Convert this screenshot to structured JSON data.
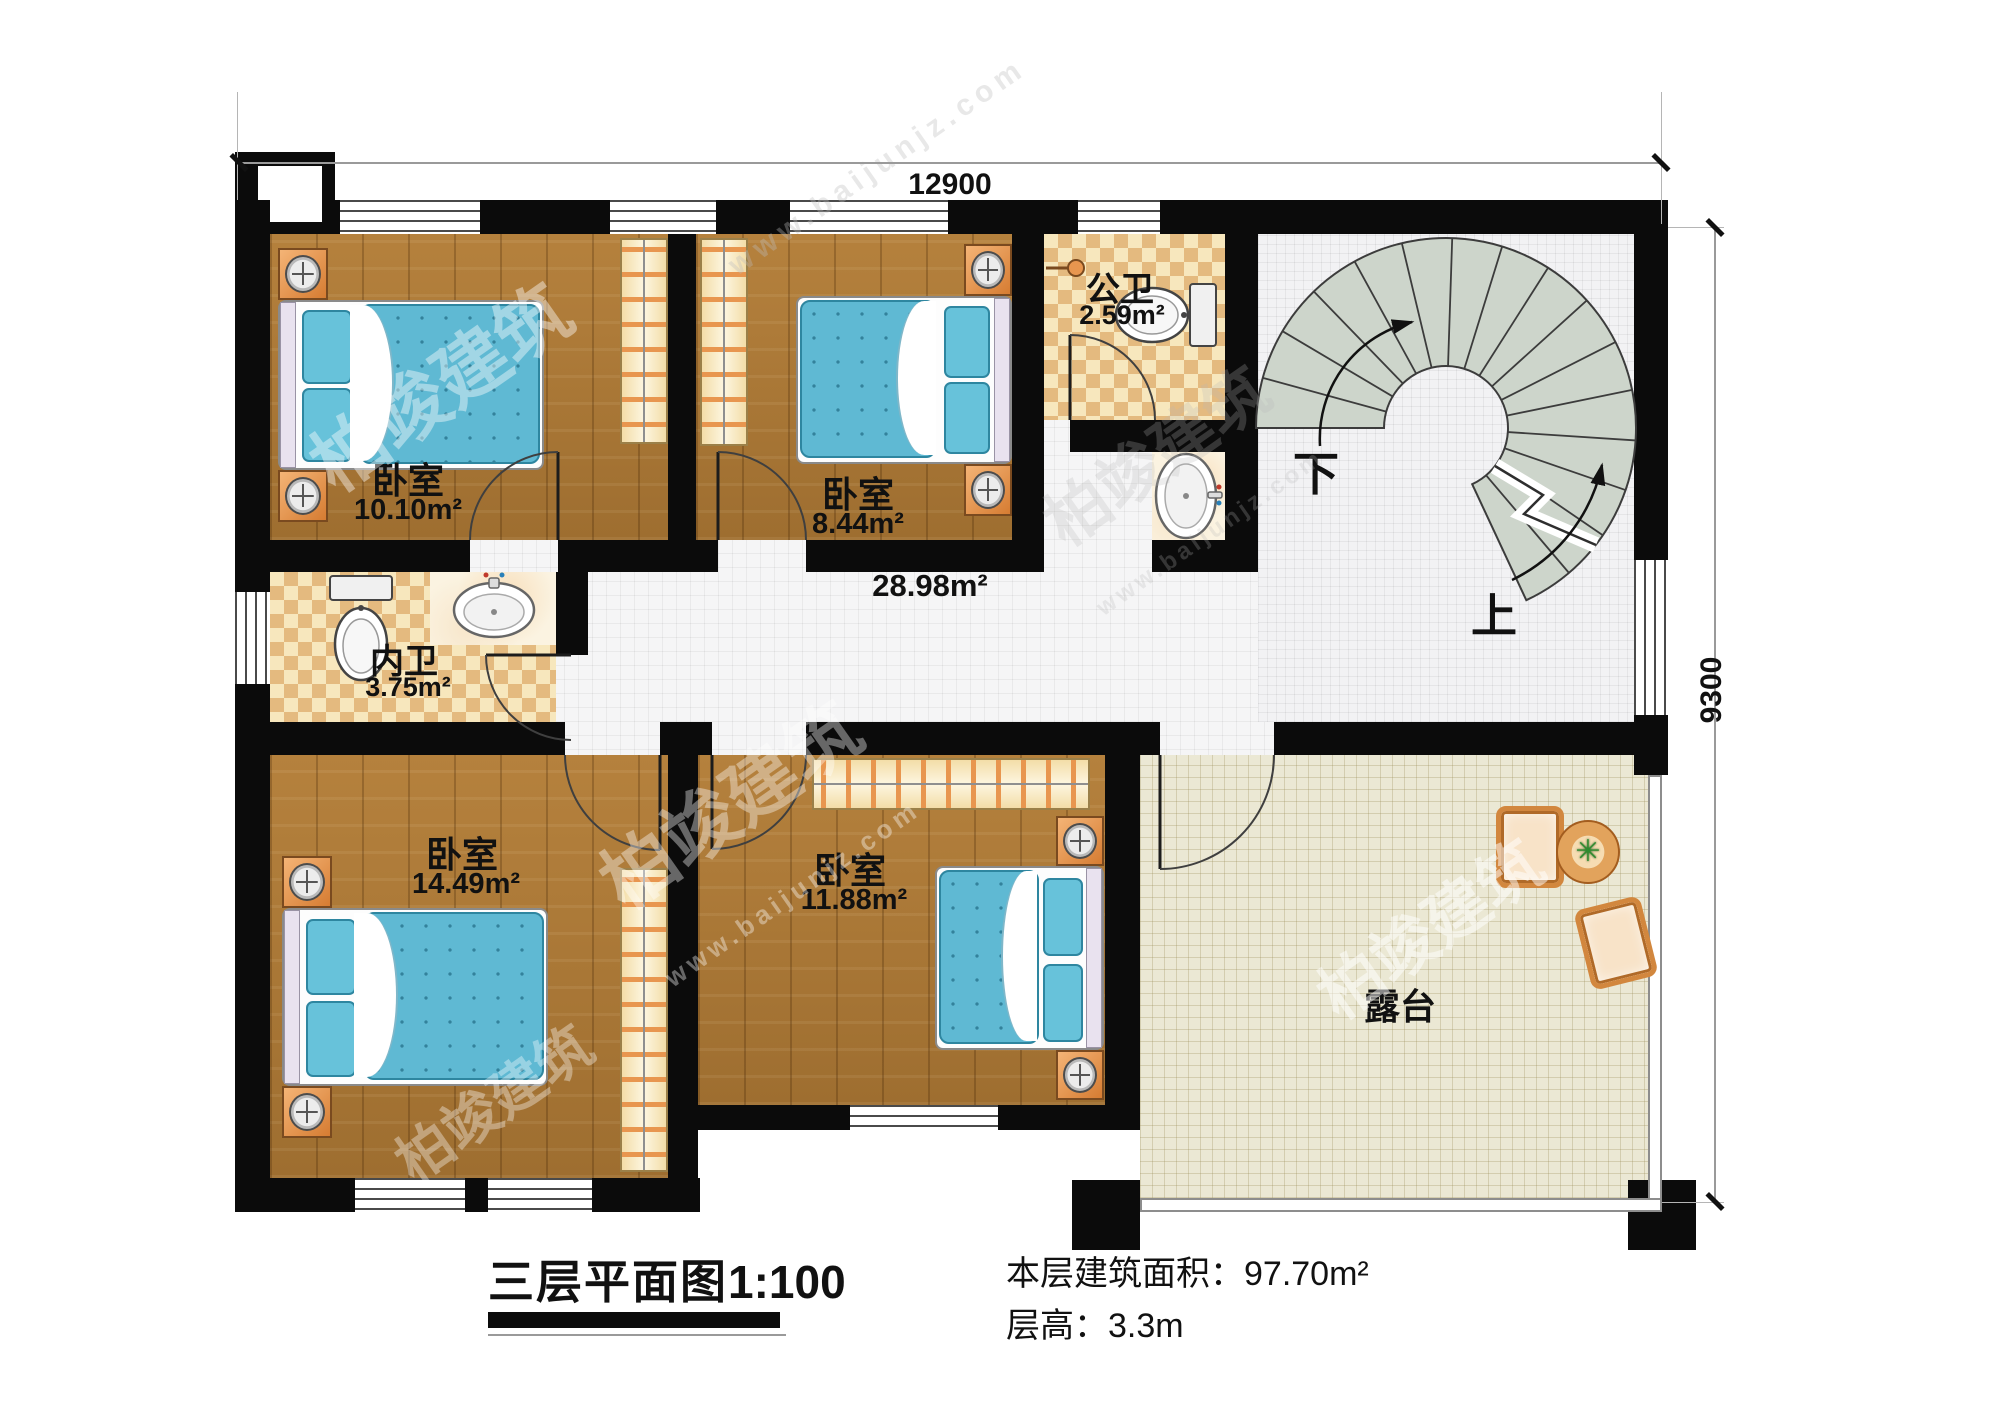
{
  "dimensions": {
    "top": "12900",
    "right": "9300"
  },
  "rooms": {
    "bedroom1": {
      "name": "卧室",
      "area": "10.10m²"
    },
    "bedroom2": {
      "name": "卧室",
      "area": "8.44m²"
    },
    "public_bath": {
      "name": "公卫",
      "area": "2.59m²"
    },
    "private_bath": {
      "name": "内卫",
      "area": "3.75m²"
    },
    "hallway": {
      "area": "28.98m²"
    },
    "bedroom3": {
      "name": "卧室",
      "area": "14.49m²"
    },
    "bedroom4": {
      "name": "卧室",
      "area": "11.88m²"
    },
    "terrace": {
      "name": "露台"
    }
  },
  "stairs": {
    "down_label": "下",
    "up_label": "上"
  },
  "titleblock": {
    "plan_title": "三层平面图",
    "scale": "1:100",
    "floor_area_label": "本层建筑面积：",
    "floor_area_value": "97.70m²",
    "floor_height_label": "层高：",
    "floor_height_value": "3.3m"
  },
  "watermark": {
    "brand": "柏竣建筑",
    "site": "www.baijunjz.com"
  },
  "colors": {
    "wall": "#0b0b0b",
    "wood_floor": "#ab7838",
    "checker_light": "#f7e7bd",
    "checker_dark": "#e4ba7f",
    "hall_tile": "#f5f5f6",
    "terrace_floor": "#ebe8d4",
    "stair_tread": "#cdd5cb",
    "bed_blue": "#5fb9d3",
    "furniture_orange": "#e8964f"
  }
}
